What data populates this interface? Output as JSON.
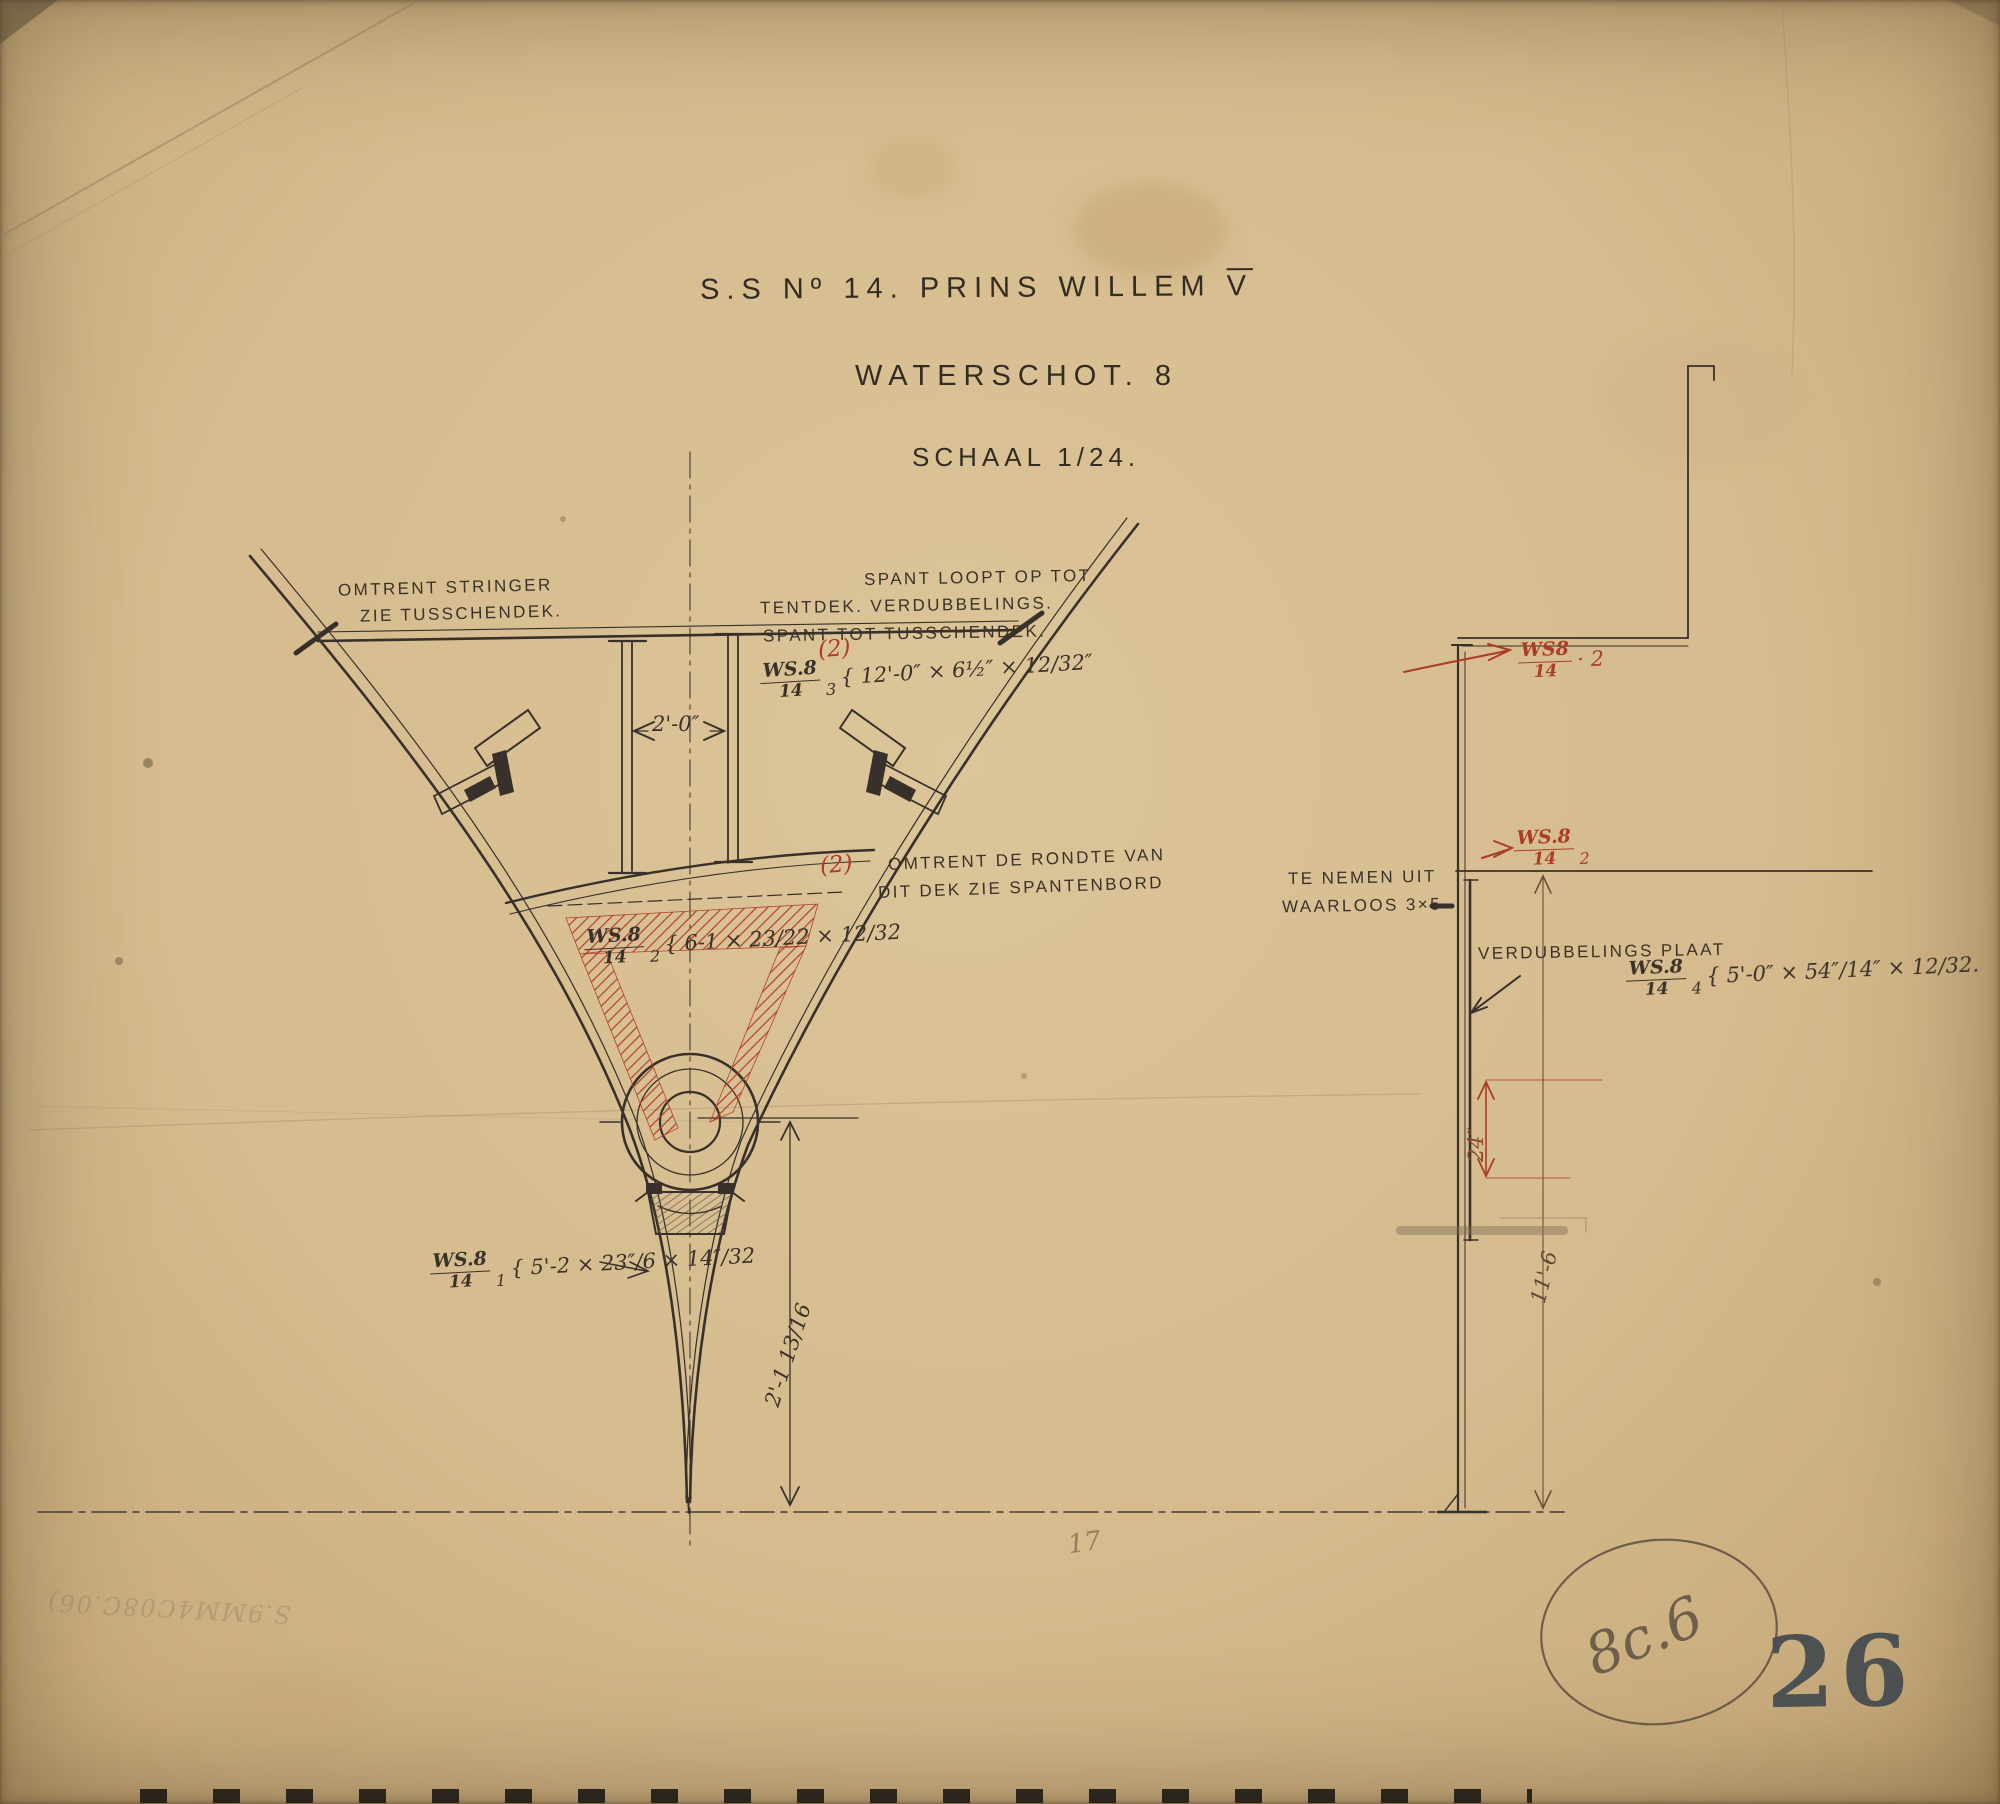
{
  "colors": {
    "paper": "#d5bb8d",
    "ink": "#38302a",
    "red_ink": "#ab3c28",
    "pencil": "#75654c",
    "stamp": "#474c50"
  },
  "title": {
    "line1": "S.S Nº 14. PRINS WILLEM",
    "line1_numeral": "V",
    "line2": "WATERSCHOT. 8",
    "line3": "SCHAAL 1/24."
  },
  "section_view": {
    "note_stringer_1": "OMTRENT STRINGER",
    "note_stringer_2": "ZIE TUSSCHENDEK.",
    "note_spant_1": "SPANT LOOPT OP TOT",
    "note_spant_2": "TENTDEK. VERDUBBELINGS.",
    "note_spant_3": "SPANT TOT TUSSCHENDEK.",
    "note_rondte_1": "OMTRENT DE RONDTE VAN",
    "note_rondte_2": "DIT DEK ZIE SPANTENBORD",
    "spec3": {
      "num": "WS.8",
      "den": "14",
      "idx": "3",
      "dims": "{ 12'-0″ × 6½″ × 12/32″"
    },
    "spec2": {
      "num": "WS.8",
      "den": "14",
      "idx": "2",
      "dims": "{ 6-1 × 23/22 × 12/32"
    },
    "spec1": {
      "num": "WS.8",
      "den": "14",
      "idx": "1",
      "dims": "{ 5'-2 × 23″/6 × 14″/32"
    },
    "red_mark_upper": "(2)",
    "red_mark_lower": "(2)",
    "dim_width": "2'-0″",
    "dim_height": "2'-1 13/16"
  },
  "profile_view": {
    "red_spec_top": {
      "num": "WS8",
      "den": "14",
      "suffix": "· 2"
    },
    "red_spec_mid": {
      "num": "WS.8",
      "den": "14",
      "suffix": "2"
    },
    "note_waarloos_1": "TE NEMEN UIT",
    "note_waarloos_2": "WAARLOOS 3×5",
    "plate_label": "VERDUBBELINGS PLAAT",
    "spec4": {
      "num": "WS.8",
      "den": "14",
      "idx": "4",
      "dims": "{ 5'-0″ × 54″/14″ × 12/32."
    },
    "dim_plate": "24″",
    "dim_height": "11'-6"
  },
  "marks": {
    "pencil_note": "17",
    "archive_code": "8c.6",
    "sheet_stamp": "26",
    "faint_inscription": "S.9MM4C08C.06)"
  }
}
